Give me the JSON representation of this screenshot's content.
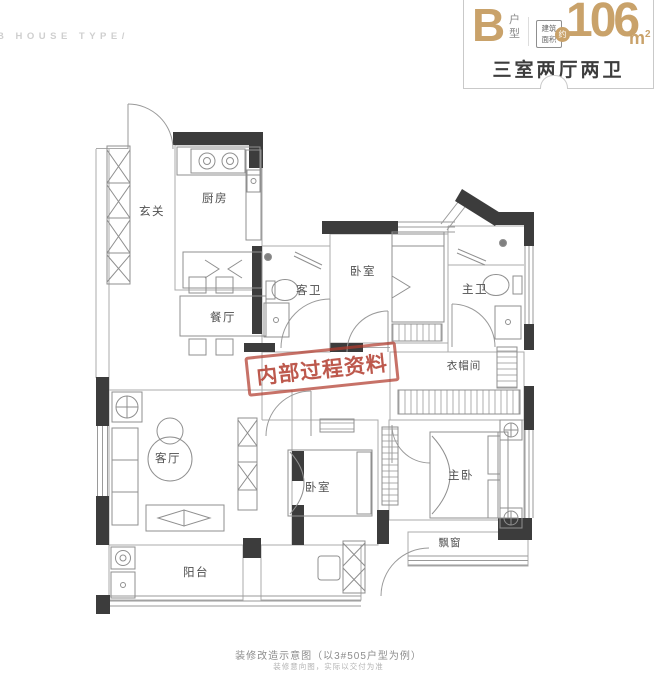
{
  "watermark": "B HOUSE TYPE/",
  "header": {
    "type_letter": "B",
    "type_suffix": "户型",
    "area_caption_top": "建筑",
    "area_caption_bottom": "面积",
    "area_approx": "约",
    "area_value": "106",
    "area_unit": "m",
    "area_unit_exp": "2",
    "layout_summary": "三室两厅两卫"
  },
  "rooms": [
    {
      "id": "entry",
      "label": "玄关"
    },
    {
      "id": "kitchen",
      "label": "厨房"
    },
    {
      "id": "dining",
      "label": "餐厅"
    },
    {
      "id": "guest-bath",
      "label": "客卫"
    },
    {
      "id": "bedroom-north",
      "label": "卧室"
    },
    {
      "id": "master-bath",
      "label": "主卫"
    },
    {
      "id": "cloakroom",
      "label": "衣帽间"
    },
    {
      "id": "living-room",
      "label": "客厅"
    },
    {
      "id": "bedroom-south",
      "label": "卧室"
    },
    {
      "id": "master-bedroom",
      "label": "主卧"
    },
    {
      "id": "bay-window",
      "label": "飘窗"
    },
    {
      "id": "balcony",
      "label": "阳台"
    }
  ],
  "stamp": {
    "text": "内部过程资料"
  },
  "footer": {
    "line1": "装修改造示意图（以3#505户型为例）",
    "line2": "装修意向图，实际以交付为准"
  },
  "colors": {
    "accent_gold": "#c9a26a",
    "stamp_red": "#b23c2e",
    "wall_dark": "#3c3c3c"
  }
}
